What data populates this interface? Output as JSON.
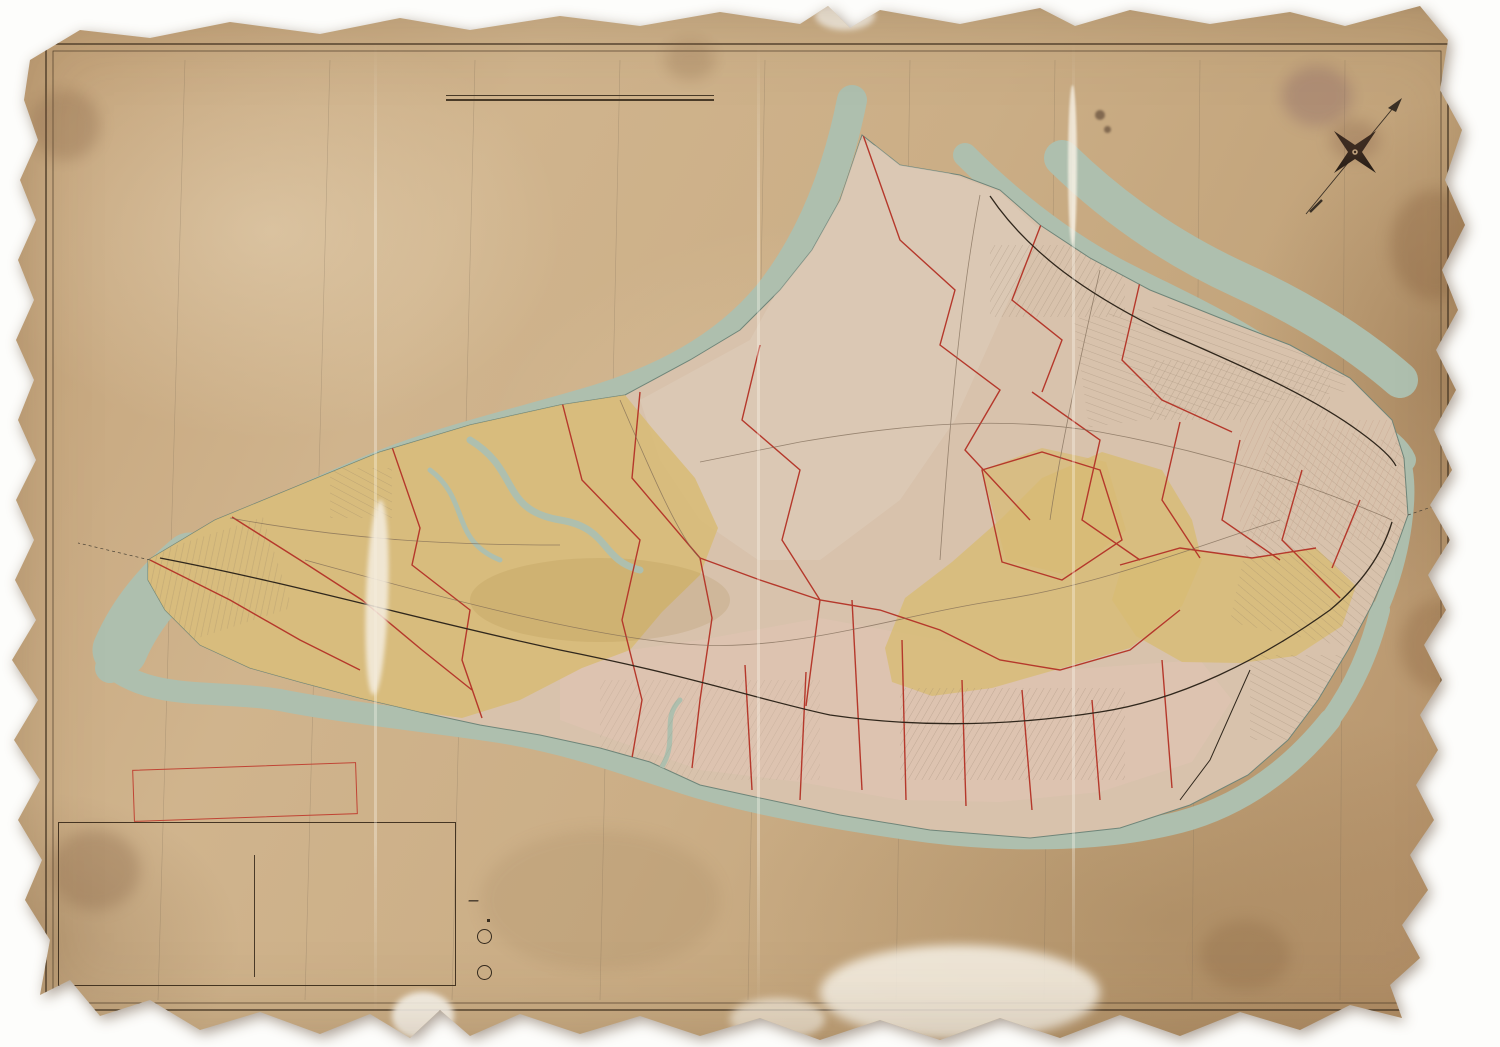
{
  "colors": {
    "paper": "#c9ac83",
    "water": "#aebfae",
    "ward_yellow": "#d8bb74",
    "ward_pink": "#e2c4b4",
    "plate_red": "#b23727",
    "ink": "#3a2f22"
  },
  "title_block": {
    "l1": "Outline & Index",
    "l2": "MAP",
    "l3": "OF THE",
    "l4a": "BOROUGH",
    "l4b": "OF",
    "l4c": "RICHMOND",
    "l5": "CITY OF NEW YORK",
    "l6": "1898."
  },
  "scale": {
    "label": "Scale One Inch equals ½ Mile.",
    "ticks": [
      {
        "t": "0",
        "x": 6
      },
      {
        "t": "¼",
        "x": 26
      },
      {
        "t": "½",
        "x": 46
      },
      {
        "t": "¾",
        "x": 66
      },
      {
        "t": "1 mile",
        "x": 105
      },
      {
        "t": "1½",
        "x": 160
      },
      {
        "t": "2 miles",
        "x": 240
      }
    ]
  },
  "note_box": {
    "l1": "NOTE: THE RED LINES AND FIGURES ON",
    "l2": "THIS MAP CORRESPOND WITH AND REFER",
    "l3": "TO THE PLATES IN THE ATLAS."
  },
  "key": {
    "title": "KEY",
    "left_items": [
      {
        "t": "Brick Building",
        "chip": "#e9ddc2"
      },
      {
        "t": "Stone ″",
        "chip": "#cfc0a0"
      },
      {
        "t": "Iron ″",
        "chip": "#b9b1a1"
      },
      {
        "t": "Frame ″",
        "chip": "#e0c97e"
      },
      {
        "t": "Stable",
        "chip": "#ddc680"
      },
      {
        "t": "Shed",
        "chip": "#dbc47e"
      },
      {
        "t": "Greenhouse",
        "chip": "#d6bf7a"
      },
      {
        "t": "Paved Street",
        "chip": "#bdae96"
      },
      {
        "t": "Street &c.",
        "chip": "#efe6d2"
      }
    ],
    "right_items": [
      {
        "t": "Steam Railroad",
        "smp": "smp-rail"
      },
      {
        "t": "Electric ″",
        "smp": "smp-dash"
      },
      {
        "t": "Water Pipe with size",
        "smp": "smp-pipe"
      },
      {
        "t": "Sewer",
        "smp": "smp-line"
      },
      {
        "t": "Ward Line",
        "smp": "smp-ward"
      },
      {
        "t": "Hydrant",
        "smp": "smp-hyd"
      },
      {
        "t": "Adjoining Plate",
        "smp": "smp-line"
      }
    ],
    "refers_note": "Refers to Marginal map number and date of Map filed in County Clerks Office at Richmond.",
    "plate_num": "6",
    "plate_letter": "B"
  },
  "ward_note": {
    "title": "NOTE",
    "rows": [
      [
        "Ward",
        "1",
        "Formerly",
        "Castleton."
      ],
      [
        "″",
        "2",
        "″",
        "Middletown."
      ],
      [
        "″",
        "3",
        "″",
        "Northfield."
      ],
      [
        "″",
        "4",
        "″",
        "Southfield."
      ],
      [
        "″",
        "5",
        "″",
        "Westfield."
      ]
    ]
  },
  "credits": {
    "lith": "A.H.MUELLER, LITH. PHILADA. PA.",
    "copyright": "Copyright secured 1898 by E. Robinson"
  },
  "labels": {
    "towns": [
      {
        "t": "Elizabethport",
        "x": 1032,
        "y": 122
      },
      {
        "t": "Howland Hook",
        "x": 1012,
        "y": 186,
        "s": 11
      },
      {
        "t": "Old Place",
        "x": 974,
        "y": 212
      },
      {
        "t": "Mariners Harbor",
        "x": 1090,
        "y": 268,
        "s": 11
      },
      {
        "t": "Summerville",
        "x": 978,
        "y": 290
      },
      {
        "t": "Elm Park",
        "x": 1128,
        "y": 313
      },
      {
        "t": "Bergen",
        "x": 1196,
        "y": 304
      },
      {
        "t": "Point",
        "x": 1196,
        "y": 315
      },
      {
        "t": "Port",
        "x": 1186,
        "y": 340
      },
      {
        "t": "Richmond",
        "x": 1198,
        "y": 352
      },
      {
        "t": "Port Johnson",
        "x": 1324,
        "y": 368,
        "s": 9
      },
      {
        "t": "West New Brighton",
        "x": 1210,
        "y": 382,
        "s": 9
      },
      {
        "t": "Bloomfield",
        "x": 892,
        "y": 274
      },
      {
        "t": "Chelsea",
        "x": 800,
        "y": 310
      },
      {
        "t": "Travisville",
        "x": 792,
        "y": 362
      },
      {
        "t": "Linoleumville",
        "x": 716,
        "y": 370
      },
      {
        "t": "Bulls Head",
        "x": 916,
        "y": 385
      },
      {
        "t": "Granitville",
        "x": 1056,
        "y": 370
      },
      {
        "t": "New Springville",
        "x": 890,
        "y": 438
      },
      {
        "t": "Willow Brook",
        "x": 1062,
        "y": 456
      },
      {
        "t": "National Prohibition",
        "x": 1085,
        "y": 431,
        "s": 9
      },
      {
        "t": "Park",
        "x": 1078,
        "y": 442,
        "s": 9
      },
      {
        "t": "Castleton",
        "x": 1062,
        "y": 508,
        "s": 9
      },
      {
        "t": "Corners",
        "x": 1062,
        "y": 519,
        "s": 9
      },
      {
        "t": "New Brighton",
        "x": 1388,
        "y": 462,
        "s": 11
      },
      {
        "t": "St.George",
        "x": 1420,
        "y": 524
      },
      {
        "t": "Brighton Heights",
        "x": 1242,
        "y": 514
      },
      {
        "t": "Tompkinsville",
        "x": 1400,
        "y": 568,
        "s": 11
      },
      {
        "t": "Grymes Hill",
        "x": 1218,
        "y": 572
      },
      {
        "t": "Stapleton",
        "x": 1356,
        "y": 600,
        "s": 11
      },
      {
        "t": "Concord",
        "x": 1186,
        "y": 652
      },
      {
        "t": "Clifton",
        "x": 1342,
        "y": 662
      },
      {
        "t": "Rosebank",
        "x": 1304,
        "y": 688
      },
      {
        "t": "Grasmere",
        "x": 1192,
        "y": 692
      },
      {
        "t": "Fort Wadsworth",
        "x": 1288,
        "y": 734
      },
      {
        "t": "Arrochar",
        "x": 1218,
        "y": 758
      },
      {
        "t": "Kreischerville",
        "x": 372,
        "y": 464
      },
      {
        "t": "Rossville",
        "x": 514,
        "y": 450,
        "s": 11
      },
      {
        "t": "Wood Row",
        "x": 458,
        "y": 492
      },
      {
        "t": "Greenridge",
        "x": 660,
        "y": 533
      },
      {
        "t": "Tottenville",
        "x": 222,
        "y": 547,
        "s": 11
      },
      {
        "t": "Richmond Valley",
        "x": 320,
        "y": 566
      },
      {
        "t": "Pleasant Plains",
        "x": 394,
        "y": 594
      },
      {
        "t": "Princes Bay",
        "x": 434,
        "y": 622
      },
      {
        "t": "Mount Loretto",
        "x": 292,
        "y": 632
      },
      {
        "t": "Red Bank",
        "x": 290,
        "y": 660
      },
      {
        "t": "Huguenot",
        "x": 484,
        "y": 641
      },
      {
        "t": "Annadale",
        "x": 566,
        "y": 645
      },
      {
        "t": "Eltingville",
        "x": 602,
        "y": 662
      },
      {
        "t": "Seaside",
        "x": 640,
        "y": 682
      },
      {
        "t": "Gifford's",
        "x": 736,
        "y": 681,
        "s": 9
      },
      {
        "t": "Great Kills",
        "x": 740,
        "y": 692,
        "s": 9
      },
      {
        "t": "Richmond",
        "x": 842,
        "y": 608
      },
      {
        "t": "Egbertville",
        "x": 942,
        "y": 652
      },
      {
        "t": "New Dorp",
        "x": 926,
        "y": 718
      },
      {
        "t": "Grant City",
        "x": 986,
        "y": 722
      },
      {
        "t": "Oceanview",
        "x": 1032,
        "y": 737
      },
      {
        "t": "Linden Park",
        "x": 1112,
        "y": 720
      },
      {
        "t": "Dongan Hills",
        "x": 1068,
        "y": 655,
        "s": 11
      },
      {
        "t": "Brendan",
        "x": 862,
        "y": 744
      },
      {
        "t": "Oakwood",
        "x": 888,
        "y": 763
      }
    ],
    "waters": [
      {
        "t": "ELIZABETH",
        "x": 988,
        "y": 92,
        "s": 10,
        "ls": 8
      },
      {
        "t": "NEWARK",
        "x": 1152,
        "y": 198,
        "ls": 7,
        "s": 12
      },
      {
        "t": "BAY",
        "x": 1182,
        "y": 228,
        "ls": 7,
        "s": 12
      },
      {
        "t": "KILL",
        "x": 845,
        "y": 182,
        "r": -62,
        "ls": 3,
        "s": 11
      },
      {
        "t": "ARTHUR",
        "x": 735,
        "y": 318,
        "r": -20,
        "ls": 4,
        "s": 11
      },
      {
        "t": "NEW",
        "x": 607,
        "y": 320,
        "r": -14,
        "ls": 5
      },
      {
        "t": "JERSEY",
        "x": 748,
        "y": 228,
        "r": -62,
        "ls": 5
      },
      {
        "t": "STATE",
        "x": 428,
        "y": 304,
        "r": -12,
        "ls": 7
      },
      {
        "t": "OF",
        "x": 520,
        "y": 346,
        "r": -14,
        "ls": 4
      },
      {
        "t": "STATEN",
        "x": 268,
        "y": 455,
        "r": -64,
        "ls": 4
      },
      {
        "t": "ISLAND",
        "x": 397,
        "y": 366,
        "r": -8,
        "ls": 5
      },
      {
        "t": "SOUND",
        "x": 565,
        "y": 400,
        "r": -26,
        "ls": 4
      },
      {
        "t": "LONG",
        "x": 712,
        "y": 383,
        "ls": 6,
        "s": 12
      },
      {
        "t": "NECK",
        "x": 806,
        "y": 388,
        "ls": 6,
        "s": 12
      },
      {
        "t": "KILL",
        "x": 1180,
        "y": 310,
        "r": 18,
        "ls": 5,
        "s": 12
      },
      {
        "t": "VAN",
        "x": 1318,
        "y": 374,
        "r": 62,
        "ls": 4,
        "s": 12
      },
      {
        "t": "KULL",
        "x": 1340,
        "y": 428,
        "r": 62,
        "ls": 4,
        "s": 12
      },
      {
        "t": "BAYONNE",
        "x": 1250,
        "y": 326,
        "ls": 5,
        "s": 10
      },
      {
        "t": "PERTH",
        "x": 110,
        "y": 497,
        "r": -33,
        "ls": 4
      },
      {
        "t": "AMBOY",
        "x": 162,
        "y": 468,
        "r": -28,
        "ls": 4
      },
      {
        "t": "PRINCES",
        "x": 312,
        "y": 697,
        "r": -10,
        "ls": 3
      },
      {
        "t": "BAY",
        "x": 378,
        "y": 708,
        "r": -14,
        "ls": 3
      },
      {
        "t": "GREAT KILLS",
        "x": 688,
        "y": 800,
        "ls": 4,
        "s": 11
      },
      {
        "t": "SOUTH BEACH",
        "x": 1210,
        "y": 817,
        "r": -5,
        "ls": 2,
        "s": 9
      },
      {
        "t": "THE",
        "x": 1302,
        "y": 845,
        "r": -66,
        "ls": 3,
        "s": 12
      },
      {
        "t": "NARROWS",
        "x": 1340,
        "y": 782,
        "r": -66,
        "ls": 3,
        "s": 12
      },
      {
        "t": "UPPER",
        "x": 1408,
        "y": 645,
        "ls": 4,
        "s": 11
      },
      {
        "t": "BAY",
        "x": 1418,
        "y": 670,
        "ls": 4,
        "s": 11
      },
      {
        "t": "BOROUGH",
        "x": 1390,
        "y": 836,
        "r": -62,
        "ls": 2,
        "s": 9
      },
      {
        "t": "OF",
        "x": 1412,
        "y": 790,
        "r": -62,
        "ls": 2,
        "s": 9
      },
      {
        "t": "BROOKLYN",
        "x": 1434,
        "y": 748,
        "r": -62,
        "ls": 2,
        "s": 9
      },
      {
        "t": "O",
        "x": 490,
        "y": 845,
        "s": 17
      },
      {
        "t": "W",
        "x": 590,
        "y": 871,
        "s": 17
      },
      {
        "t": "E",
        "x": 664,
        "y": 887,
        "s": 17
      },
      {
        "t": "R",
        "x": 800,
        "y": 914,
        "s": 17
      },
      {
        "t": "B",
        "x": 920,
        "y": 916,
        "s": 17
      },
      {
        "t": "A",
        "x": 1012,
        "y": 906,
        "s": 17
      },
      {
        "t": "Y",
        "x": 1103,
        "y": 906,
        "s": 17
      }
    ],
    "ward_letters": [
      {
        "t": "W",
        "x": 298,
        "y": 553
      },
      {
        "t": "A",
        "x": 372,
        "y": 545
      },
      {
        "t": "R",
        "x": 433,
        "y": 542
      },
      {
        "t": "D",
        "x": 490,
        "y": 541
      },
      {
        "t": "5",
        "x": 548,
        "y": 543
      },
      {
        "t": "W",
        "x": 793,
        "y": 467
      },
      {
        "t": "A",
        "x": 836,
        "y": 431
      },
      {
        "t": "R",
        "x": 884,
        "y": 397
      },
      {
        "t": "D",
        "x": 928,
        "y": 358
      },
      {
        "t": "W",
        "x": 1078,
        "y": 466
      },
      {
        "t": "A",
        "x": 1130,
        "y": 478
      },
      {
        "t": "R",
        "x": 1166,
        "y": 487
      },
      {
        "t": "D",
        "x": 1228,
        "y": 494
      },
      {
        "t": "1",
        "x": 1287,
        "y": 496
      },
      {
        "t": "W",
        "x": 997,
        "y": 600
      },
      {
        "t": "A",
        "x": 1052,
        "y": 600
      },
      {
        "t": "R",
        "x": 1103,
        "y": 599
      },
      {
        "t": "D",
        "x": 1158,
        "y": 597
      },
      {
        "t": "2",
        "x": 1206,
        "y": 607,
        "s": 13
      },
      {
        "t": "W",
        "x": 818,
        "y": 758
      },
      {
        "t": "A",
        "x": 892,
        "y": 767
      },
      {
        "t": "R",
        "x": 968,
        "y": 772
      },
      {
        "t": "D",
        "x": 1045,
        "y": 768
      },
      {
        "t": "4",
        "x": 1155,
        "y": 737,
        "s": 13
      }
    ],
    "plates": [
      {
        "t": "32",
        "x": 978,
        "y": 227
      },
      {
        "t": "31",
        "x": 1047,
        "y": 281
      },
      {
        "t": "30",
        "x": 1092,
        "y": 324
      },
      {
        "t": "5",
        "x": 1140,
        "y": 357
      },
      {
        "t": "33",
        "x": 884,
        "y": 349
      },
      {
        "t": "6",
        "x": 1033,
        "y": 393
      },
      {
        "t": "4",
        "x": 1181,
        "y": 420
      },
      {
        "t": "3",
        "x": 1241,
        "y": 437
      },
      {
        "t": "34",
        "x": 742,
        "y": 489
      },
      {
        "t": "7",
        "x": 1140,
        "y": 508
      },
      {
        "t": "29",
        "x": 1047,
        "y": 527
      },
      {
        "t": "2",
        "x": 1296,
        "y": 482
      },
      {
        "t": "1",
        "x": 1366,
        "y": 507
      },
      {
        "t": "8",
        "x": 1246,
        "y": 520
      },
      {
        "t": "9",
        "x": 1330,
        "y": 565
      },
      {
        "t": "25",
        "x": 448,
        "y": 466
      },
      {
        "t": "24",
        "x": 358,
        "y": 533
      },
      {
        "t": "23",
        "x": 218,
        "y": 549
      },
      {
        "t": "22",
        "x": 170,
        "y": 592
      },
      {
        "t": "26",
        "x": 578,
        "y": 577
      },
      {
        "t": "21",
        "x": 318,
        "y": 633
      },
      {
        "t": "20",
        "x": 534,
        "y": 698
      },
      {
        "t": "18",
        "x": 648,
        "y": 729
      },
      {
        "t": "19",
        "x": 707,
        "y": 719
      },
      {
        "t": "18",
        "x": 745,
        "y": 666
      },
      {
        "t": "18",
        "x": 764,
        "y": 736
      },
      {
        "t": "19",
        "x": 806,
        "y": 756
      },
      {
        "t": "17",
        "x": 894,
        "y": 750
      },
      {
        "t": "16",
        "x": 976,
        "y": 763
      },
      {
        "t": "15",
        "x": 1080,
        "y": 748
      },
      {
        "t": "27",
        "x": 941,
        "y": 620
      },
      {
        "t": "28",
        "x": 1131,
        "y": 625
      },
      {
        "t": "11",
        "x": 1196,
        "y": 597
      },
      {
        "t": "10",
        "x": 1281,
        "y": 607
      },
      {
        "t": "13",
        "x": 1224,
        "y": 682
      },
      {
        "t": "12",
        "x": 1271,
        "y": 704
      },
      {
        "t": "14",
        "x": 1198,
        "y": 771
      }
    ],
    "smalls": [
      {
        "t": "Ferry to Perth Amboy",
        "x": 192,
        "y": 513,
        "r": -7
      },
      {
        "t": "Ferry to New York",
        "x": 1416,
        "y": 540,
        "r": -5
      },
      {
        "t": "10 Miles from City Hall Manhattan",
        "x": 88,
        "y": 468,
        "r": -76
      },
      {
        "t": "9 Miles",
        "x": 187,
        "y": 430,
        "r": -78
      },
      {
        "t": "10 Miles",
        "x": 386,
        "y": 300,
        "r": -78
      },
      {
        "t": "11 Miles",
        "x": 684,
        "y": 186,
        "r": -76
      },
      {
        "t": "Marine Hospital",
        "x": 1350,
        "y": 628,
        "i": 1
      },
      {
        "t": "FORT WADSWORTH",
        "x": 1302,
        "y": 762
      },
      {
        "t": "FORT TOMPKINS",
        "x": 1298,
        "y": 784
      },
      {
        "t": "Fort Lafayette",
        "x": 1352,
        "y": 818,
        "i": 1
      },
      {
        "t": "FORT HAMILTON",
        "x": 1434,
        "y": 830
      },
      {
        "t": "Hoffman Island",
        "x": 1188,
        "y": 892,
        "i": 1
      },
      {
        "t": "Lower Quarantine",
        "x": 1194,
        "y": 900,
        "i": 1
      },
      {
        "t": "MIDLAND BEACH",
        "x": 1012,
        "y": 852,
        "r": -12
      },
      {
        "t": "NEW DORP BEACH",
        "x": 920,
        "y": 840,
        "r": -22
      }
    ]
  }
}
